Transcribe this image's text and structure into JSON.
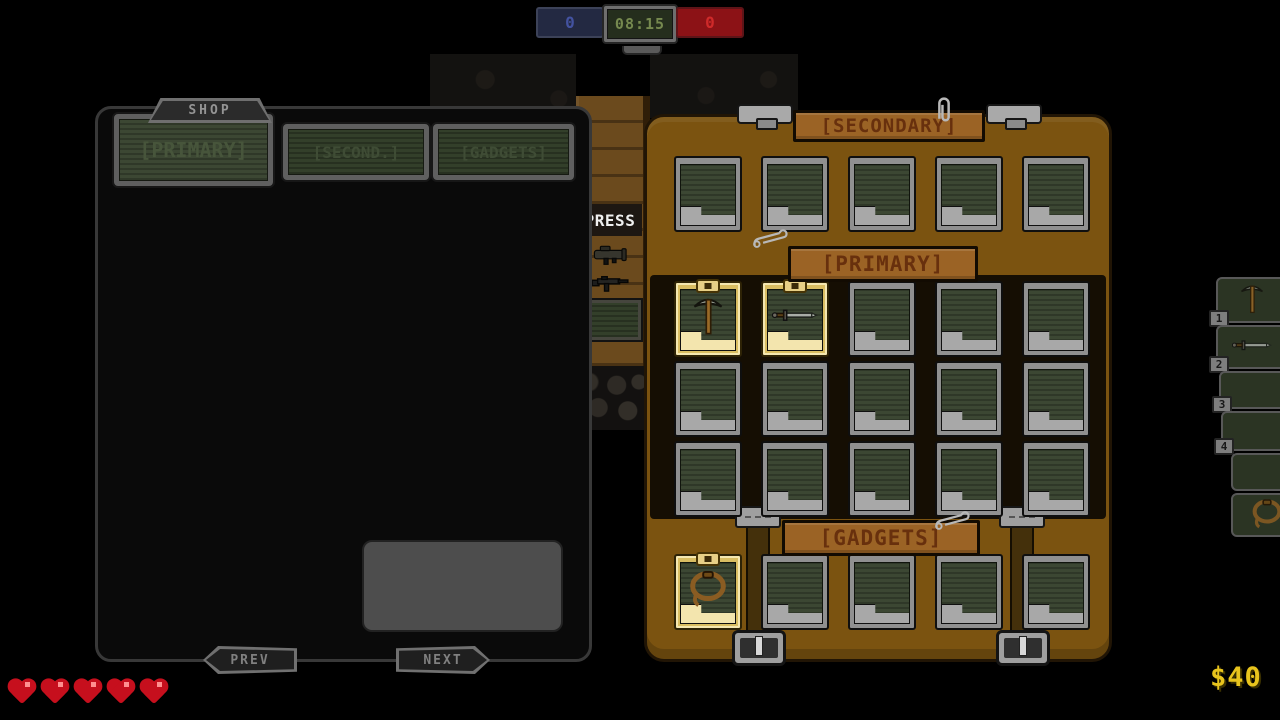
{
  "scoreboard": {
    "team_blue_score": "0",
    "timer": "08:15",
    "team_red_score": "0"
  },
  "shop": {
    "title": "SHOP",
    "tabs": [
      {
        "label": "[PRIMARY]",
        "active": true
      },
      {
        "label": "[SECOND.]",
        "active": false
      },
      {
        "label": "[GADGETS]",
        "active": false
      }
    ],
    "items": [
      {
        "name": "PISTOL",
        "count": "x12",
        "price": "$10",
        "icon": "pistol-icon",
        "highlighted": false
      },
      {
        "name": "FLAME THROWER",
        "count": "x50",
        "price": "$20",
        "icon": "flamethrower-icon",
        "highlighted": false
      },
      {
        "name": "ASSAULT RIFLE",
        "count": "x40",
        "price": "$25",
        "icon": "assault-rifle-icon",
        "highlighted": false
      },
      {
        "name": "PICKAXE",
        "count": "",
        "price": "$999",
        "icon": "pickaxe-icon",
        "highlighted": true
      },
      {
        "name": "MINE",
        "count": "x1",
        "price": "$30",
        "icon": "mine-icon",
        "highlighted": false
      },
      {
        "name": "ROCKET LAUNCHER",
        "count": "x2",
        "price": "$30",
        "icon": "rocket-launcher-icon",
        "highlighted": false
      },
      {
        "name": "SHOTGUN",
        "count": "x12",
        "price": "$20",
        "icon": "shotgun-icon",
        "highlighted": false
      },
      {
        "name": "LIGHTNING GUN",
        "count": "x50",
        "price": "$25",
        "icon": "lightning-gun-icon",
        "highlighted": false
      },
      {
        "name": "DYNAMITE",
        "count": "x1",
        "price": "$5",
        "icon": "dynamite-icon",
        "highlighted": false
      }
    ],
    "prev_label": "PREV",
    "next_label": "NEXT"
  },
  "inventory": {
    "sections": [
      {
        "label": "[SECONDARY]",
        "rows": 1,
        "cols": 5,
        "filled": {}
      },
      {
        "label": "[PRIMARY]",
        "rows": 3,
        "cols": 5,
        "filled": {
          "0": "pickaxe-icon",
          "1": "sword-icon"
        }
      },
      {
        "label": "[GADGETS]",
        "rows": 1,
        "cols": 5,
        "filled": {
          "0": "lasso-icon"
        }
      }
    ]
  },
  "hotbar": {
    "slots": [
      {
        "key": "1",
        "icon": "pickaxe-icon"
      },
      {
        "key": "2",
        "icon": "sword-icon"
      },
      {
        "key": "3",
        "icon": ""
      },
      {
        "key": "4",
        "icon": ""
      },
      {
        "key": "",
        "icon": ""
      },
      {
        "key": "",
        "icon": "lasso-icon"
      }
    ]
  },
  "world": {
    "press_sign": "PRESS"
  },
  "hud": {
    "hearts": 5,
    "money": "$40"
  },
  "colors": {
    "chest_brown": "#7b5310",
    "screen_green": "#3c4733",
    "highlight_red": "#8a140c",
    "gold_slot": "#d9bd62",
    "money_yellow": "#e8c41d",
    "heart_red": "#c60f1d"
  }
}
